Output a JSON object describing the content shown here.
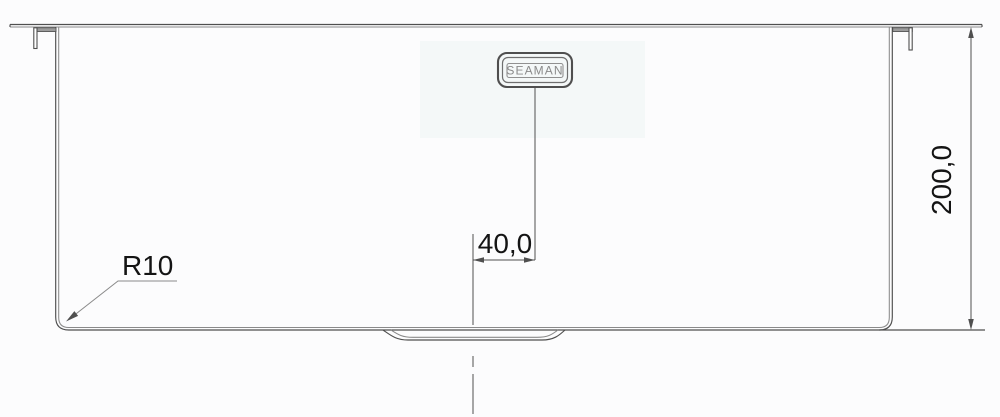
{
  "drawing": {
    "brand_badge": {
      "label": "SEAMAN"
    },
    "labels": {
      "corner_radius": "R10",
      "offset_width": "40,0",
      "depth": "200,0"
    },
    "colors": {
      "line": "#4f4f4f",
      "line_light": "#8a8a8a",
      "text": "#141414",
      "logo": "#8a8a8a",
      "background": "#fcfcfd",
      "tint": "#f4f8f8"
    }
  }
}
